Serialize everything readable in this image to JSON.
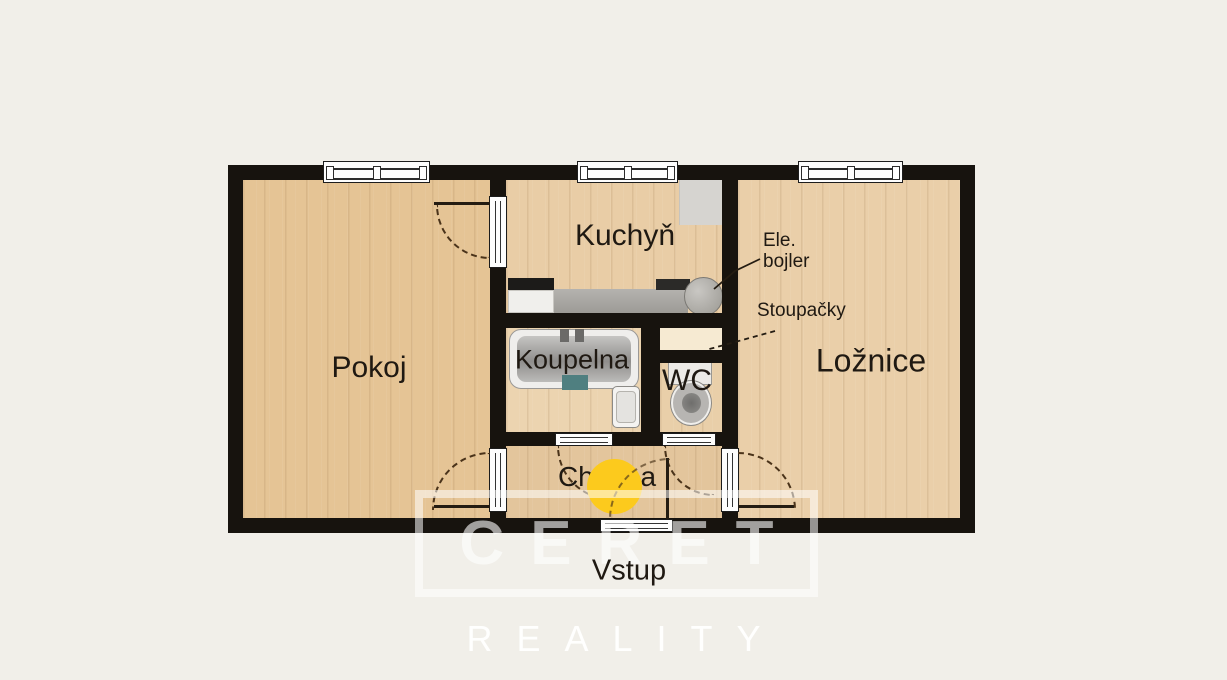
{
  "plan": {
    "rooms": {
      "pokoj": "Pokoj",
      "kuchyn": "Kuchyň",
      "koupelna": "Koupelna",
      "wc": "WC",
      "loznice": "Ložnice",
      "chodba": "Chodba"
    },
    "entrance_label": "Vstup",
    "annotations": {
      "boiler_line1": "Ele.",
      "boiler_line2": "bojler",
      "risers": "Stoupačky"
    },
    "colors": {
      "wall": "#17130e",
      "floor_wood": "#e7c79d",
      "entry_marker_yellow": "#fcca1d",
      "risers_fill": "#f6ead2",
      "counter_gray": "#a9a7a2"
    }
  },
  "watermark": {
    "brand": "CERET",
    "tagline": "REALITY"
  }
}
